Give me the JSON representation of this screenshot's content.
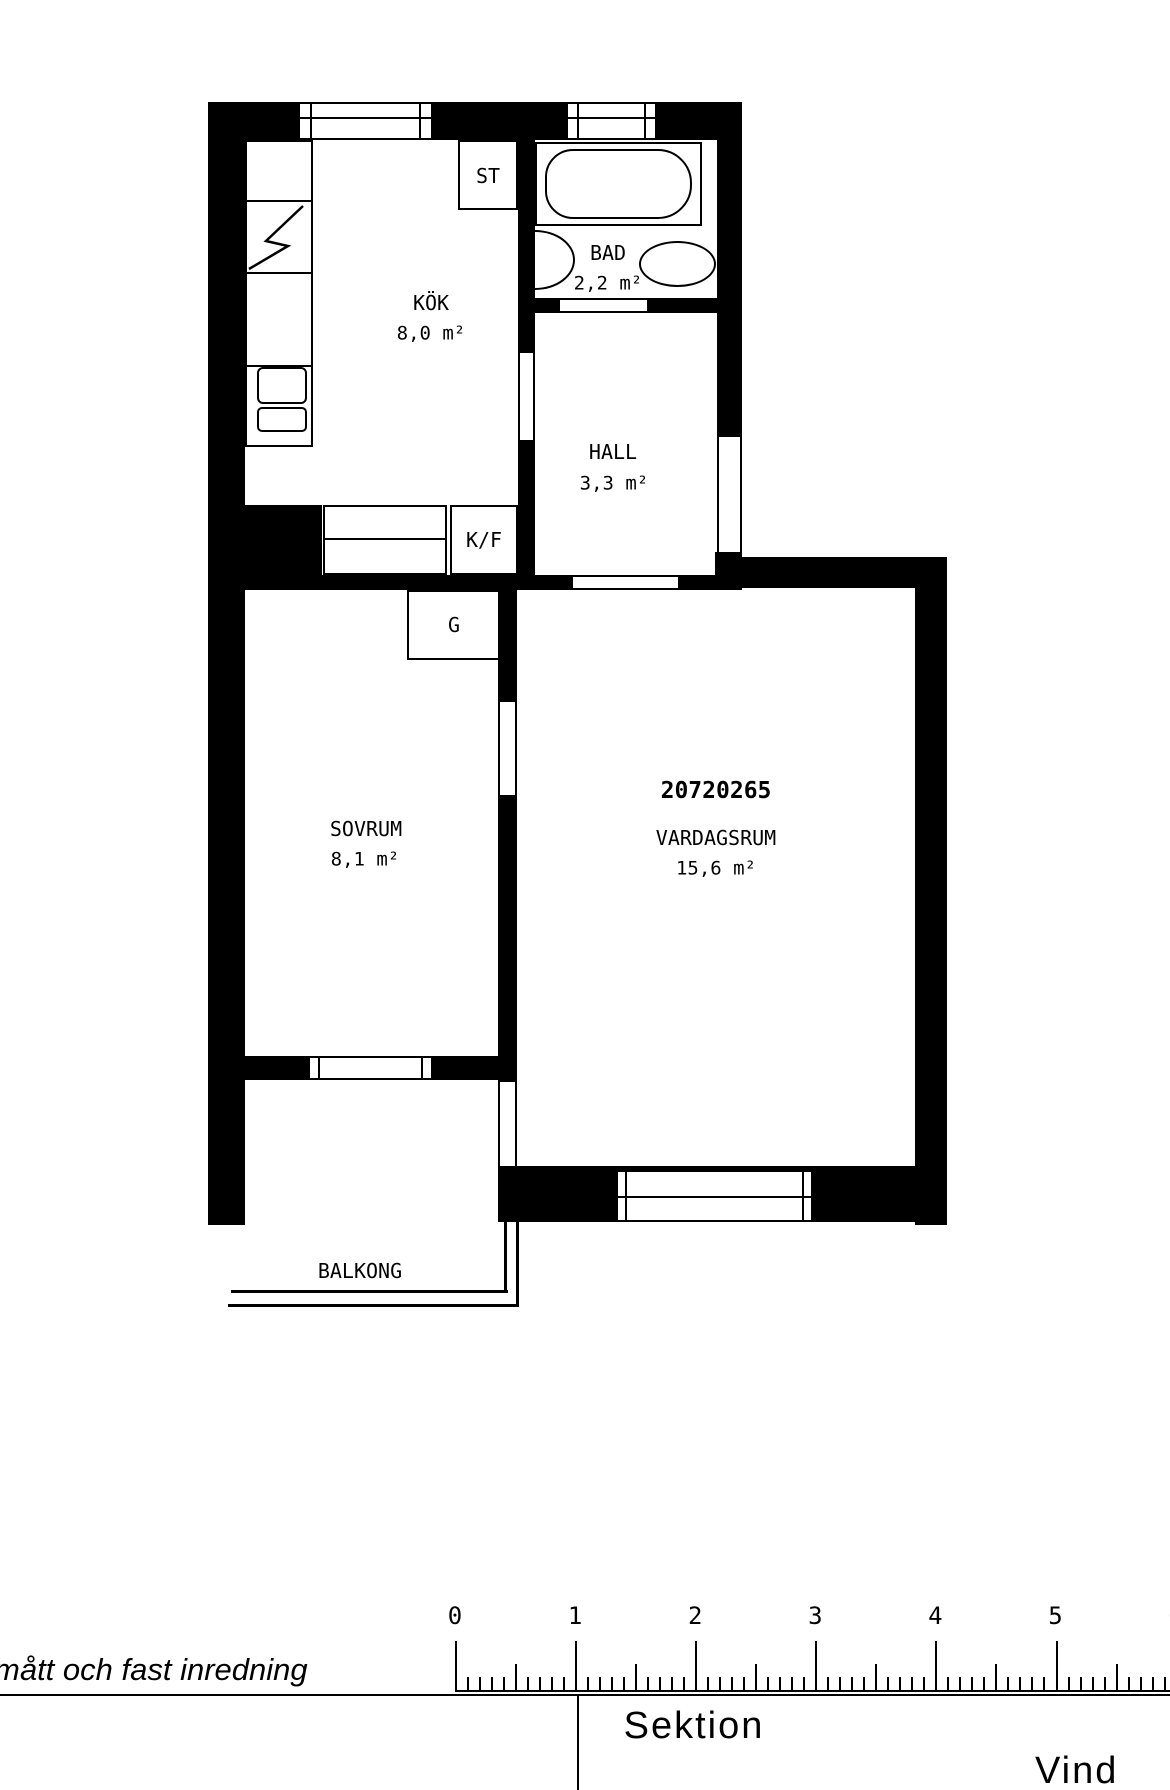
{
  "plan": {
    "plan_number": "20720265",
    "rooms": [
      {
        "name": "KÖK",
        "area": "8,0 m²"
      },
      {
        "name": "BAD",
        "area": "2,2 m²"
      },
      {
        "name": "HALL",
        "area": "3,3 m²"
      },
      {
        "name": "SOVRUM",
        "area": "8,1 m²"
      },
      {
        "name": "VARDAGSRUM",
        "area": "15,6 m²"
      },
      {
        "name": "BALKONG"
      }
    ],
    "fixture_labels": {
      "closet": "ST",
      "fridge_freezer": "K/F",
      "wardrobe": "G"
    }
  },
  "footer": {
    "note": "mått och fast inredning",
    "section_label": "Sektion",
    "attic_label": "Vind",
    "ruler": {
      "numbers": [
        "0",
        "1",
        "2",
        "3",
        "4",
        "5",
        "6"
      ]
    }
  },
  "colors": {
    "line": "#000000",
    "background": "#ffffff"
  }
}
